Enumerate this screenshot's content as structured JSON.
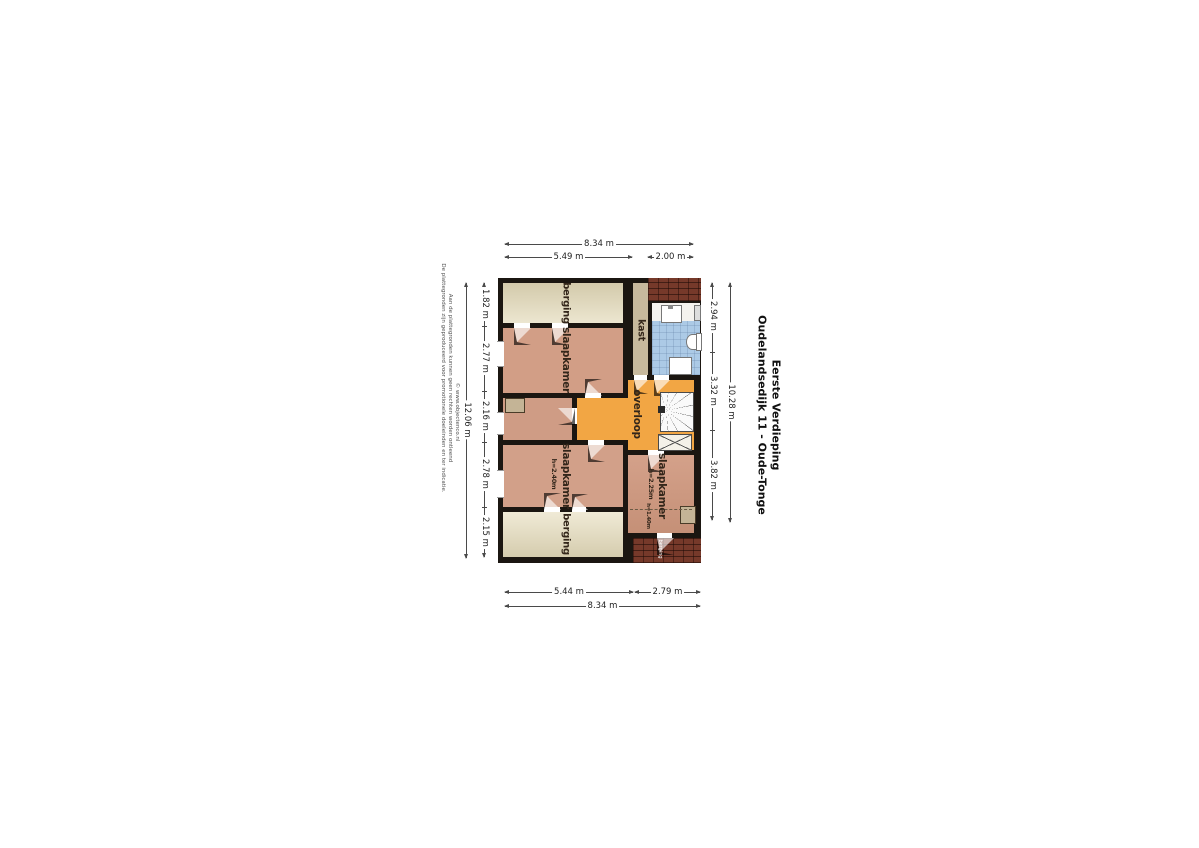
{
  "title": {
    "line1": "Oudelandsedijk 11 - Oude-Tonge",
    "line2": "Eerste Verdieping"
  },
  "disclaimer": {
    "line1": "De plattegronden zijn geproduceerd voor promotionele doeleinden en ter indicatie.",
    "line2": "Aan de plattegronden kunnen geen rechten worden ontleend",
    "line3": "© www.objectenco.nl"
  },
  "rooms": {
    "berging_top": "berging",
    "slaapkamer_top": "slaapkamer",
    "kast": "kast",
    "overloop": "overloop",
    "slaapkamer_left": "slaapkamer",
    "slaapkamer_left_height": "h=2.40m",
    "slaapkamer_right": "slaapkamer",
    "slaapkamer_right_height": "h=2.25m",
    "knee_wall_height": "h=1.40m",
    "berging_bottom": "berging",
    "berging_roof": "berging"
  },
  "dims": {
    "top": {
      "total": "8.34 m",
      "segments": [
        "5.49 m",
        "2.00 m"
      ]
    },
    "bottom": {
      "total": "8.34 m",
      "segments": [
        "5.44 m",
        "2.79 m"
      ]
    },
    "left": {
      "total": "12.06 m",
      "segments": [
        "1.82 m",
        "2.77 m",
        "2.16 m",
        "2.78 m",
        "2.15 m"
      ]
    },
    "right": {
      "total": "10.28 m",
      "segments": [
        "2.94 m",
        "3.32 m",
        "3.82 m"
      ]
    }
  },
  "colors": {
    "wall": "#1b1611",
    "bedroom_floor": "#d29e86",
    "storage_floor": "#e7e0c6",
    "landing_floor": "#f2a644",
    "bathroom_floor": "#accae6",
    "closet_floor": "#c7b99d",
    "roof_brick": "#76392a"
  }
}
